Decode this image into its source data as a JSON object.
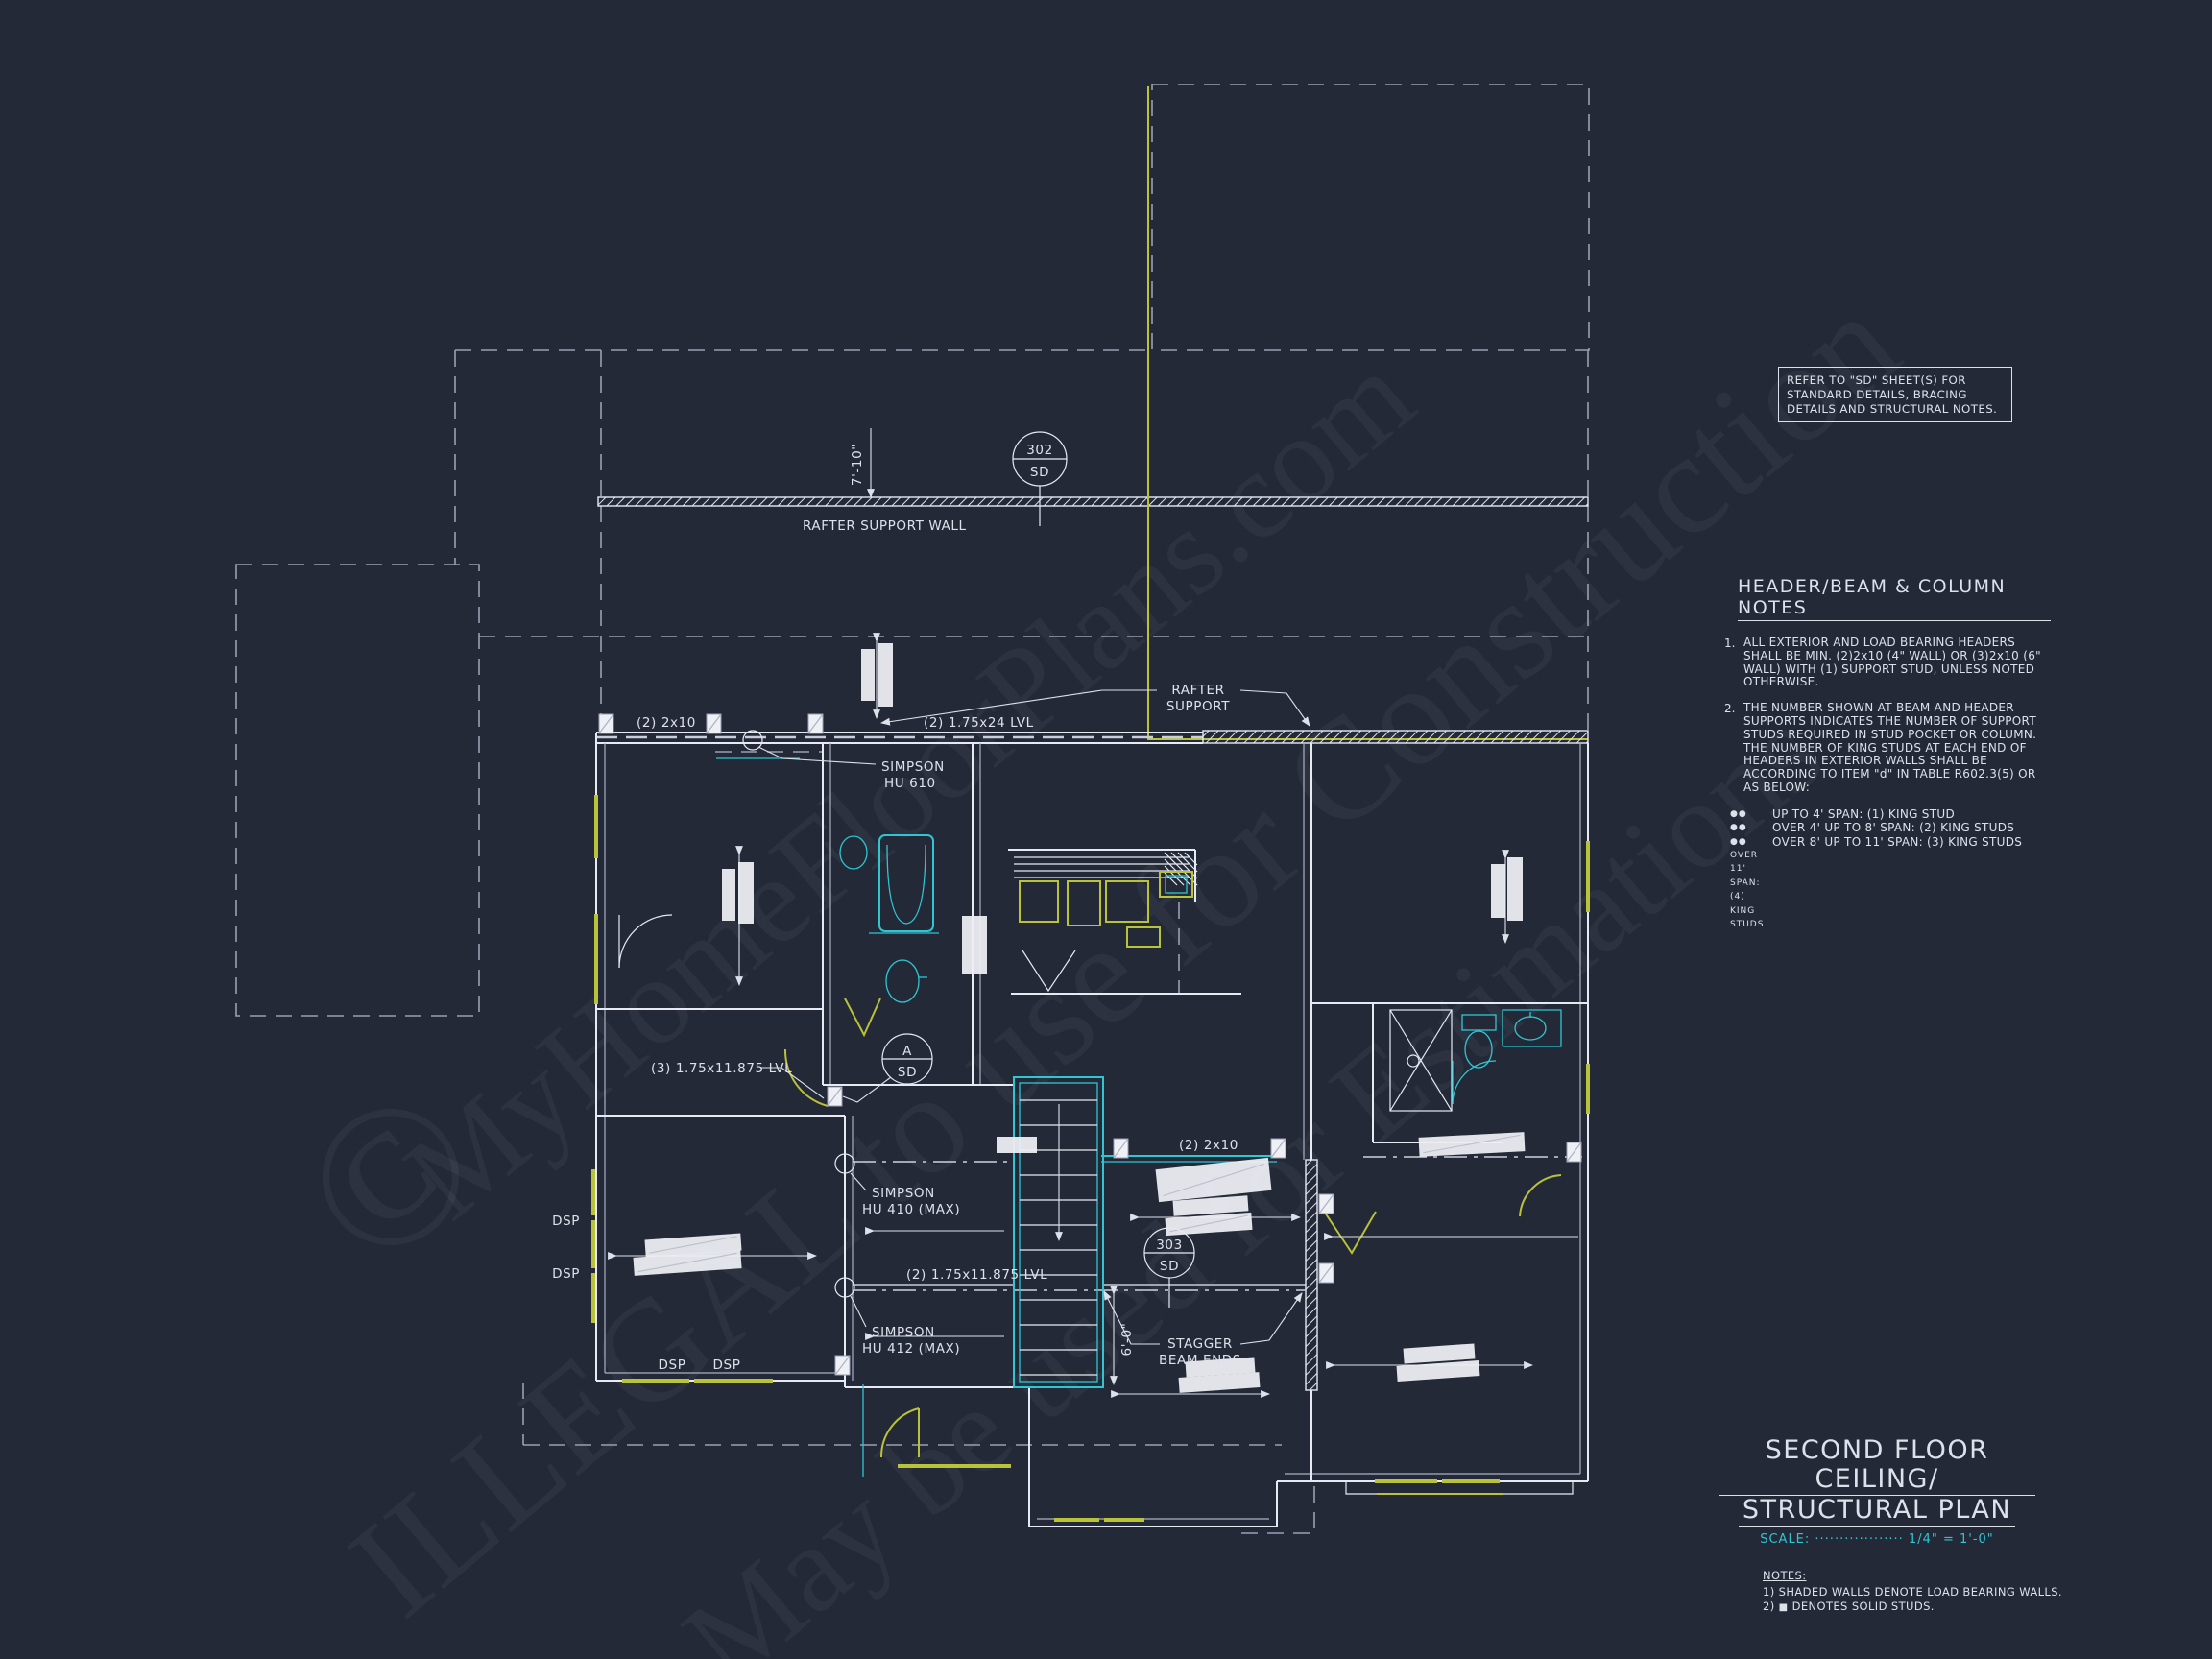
{
  "watermark": {
    "copyright": "©",
    "line1": "MyHomeFloorPlans.com",
    "line2": "ILLEGAL to use for Construction",
    "line3": "May be used for Estimations"
  },
  "ref_note": {
    "l1": "REFER TO \"SD\" SHEET(S) FOR",
    "l2": "STANDARD DETAILS, BRACING",
    "l3": "DETAILS AND STRUCTURAL NOTES."
  },
  "header_notes": {
    "title": "HEADER/BEAM & COLUMN NOTES",
    "bullet_glyph": "●●",
    "items": [
      {
        "num": "1.",
        "text": "ALL EXTERIOR AND LOAD BEARING HEADERS SHALL BE MIN. (2)2x10 (4\" WALL) OR (3)2x10 (6\" WALL) WITH (1) SUPPORT STUD, UNLESS NOTED OTHERWISE."
      },
      {
        "num": "2.",
        "text": "THE NUMBER SHOWN AT BEAM AND HEADER SUPPORTS INDICATES THE NUMBER OF SUPPORT STUDS REQUIRED IN STUD POCKET OR COLUMN. THE NUMBER OF KING STUDS AT EACH END OF HEADERS IN EXTERIOR WALLS SHALL BE ACCORDING TO ITEM \"d\" IN TABLE R602.3(5) OR AS BELOW:"
      }
    ],
    "bullets": [
      "UP TO 4' SPAN: (1) KING STUD",
      "OVER 4' UP TO 8' SPAN: (2) KING STUDS",
      "OVER 8' UP TO 11' SPAN: (3) KING STUDS",
      "OVER 11' SPAN: (4) KING STUDS"
    ]
  },
  "title_block": {
    "line1": "SECOND FLOOR CEILING/",
    "line2": "STRUCTURAL PLAN",
    "scale": "SCALE: ·················· 1/4\" = 1'-0\""
  },
  "general_notes": {
    "title": "NOTES:",
    "item1": "1) SHADED WALLS DENOTE LOAD BEARING WALLS.",
    "item2_prefix": "2)",
    "item2_square": "■",
    "item2_text": "DENOTES SOLID STUDS."
  },
  "plan": {
    "rafter_support_wall": "RAFTER SUPPORT WALL",
    "dim_7_10": "7'-10\"",
    "dim_6_0": "6'-0\"",
    "callout_302_top": "302",
    "callout_302_bot": "SD",
    "callout_303_top": "303",
    "callout_303_bot": "SD",
    "callout_a_top": "A",
    "callout_a_bot": "SD",
    "label_2x10_top": "(2) 2x10",
    "label_lvl24": "(2) 1.75x24 LVL",
    "simpson_610_l1": "SIMPSON",
    "simpson_610_l2": "HU 610",
    "rafter_support_l1": "RAFTER",
    "rafter_support_l2": "SUPPORT",
    "label_lvl11875_3": "(3) 1.75x11.875 LVL",
    "simpson_410_l1": "SIMPSON",
    "simpson_410_l2": "HU 410 (MAX)",
    "label_lvl11875_2": "(2) 1.75x11.875 LVL",
    "simpson_412_l1": "SIMPSON",
    "simpson_412_l2": "HU 412 (MAX)",
    "label_2x10_mid": "(2) 2x10",
    "stagger_l1": "STAGGER",
    "stagger_l2": "BEAM ENDS",
    "dsp": "DSP"
  }
}
